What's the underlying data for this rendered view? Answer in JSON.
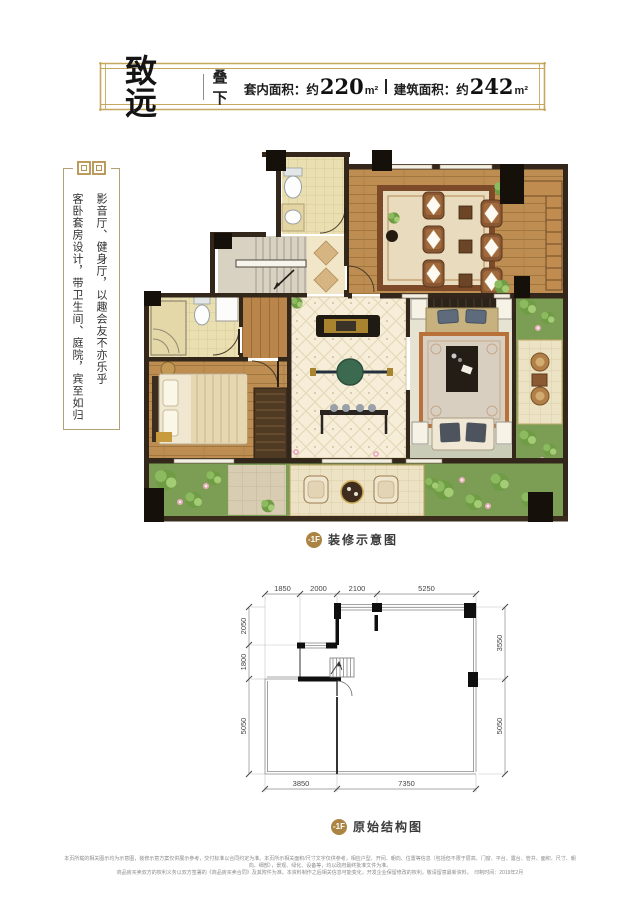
{
  "header": {
    "title": "致远",
    "subtitle": "叠下",
    "area_inner_label": "套内面积：约",
    "area_inner_value": "220",
    "area_inner_unit": "m²",
    "area_build_label": "建筑面积：约",
    "area_build_value": "242",
    "area_build_unit": "m²"
  },
  "side_panel": {
    "column_1": "影音厅、健身厅，以趣会友不亦乐乎",
    "column_2": "客卧套房设计，带卫生间、庭院，宾至如归"
  },
  "decorated_plan": {
    "badge": "-1F",
    "caption": "装修示意图"
  },
  "structure_plan": {
    "badge": "-1F",
    "caption": "原始结构图",
    "dims_top": [
      "1850",
      "2000",
      "2100",
      "5250"
    ],
    "dims_left": [
      "2050",
      "1800",
      "5050"
    ],
    "dims_right": [
      "3550",
      "5050"
    ],
    "dims_bottom": [
      "3850",
      "7350"
    ]
  },
  "footer": {
    "disclaimer_line1": "本页所载的相关图示均为示意图，装修示意方案仅供展示参考，交付标准以合同约定为准。本页所示相关面积/尺寸文字仅供参考，相应户型、开间、朝向、位置等信息（包括但不限于层高、门窗、平台、露台、管井、面积、尺寸、朝向、细部），景观、绿化、设备等，均以政府最终批准文件为准。",
    "disclaimer_line2": "商品房买卖双方的权利义务以双方签署的《商品房买卖合同》及其附件为准。本资料制作之后相关信息可能变化，开发企业保留修改的权利，敬请留意最新资料。　印制时间：2019年2月"
  },
  "colors": {
    "accent_gold": "#ab8443",
    "frame_gold": "#c6a75f",
    "wall_dark": "#33261a",
    "column_black": "#15100a",
    "wood": "#bd8d52",
    "tile": "#eadfb0",
    "garden_green": "#7b9e54"
  }
}
